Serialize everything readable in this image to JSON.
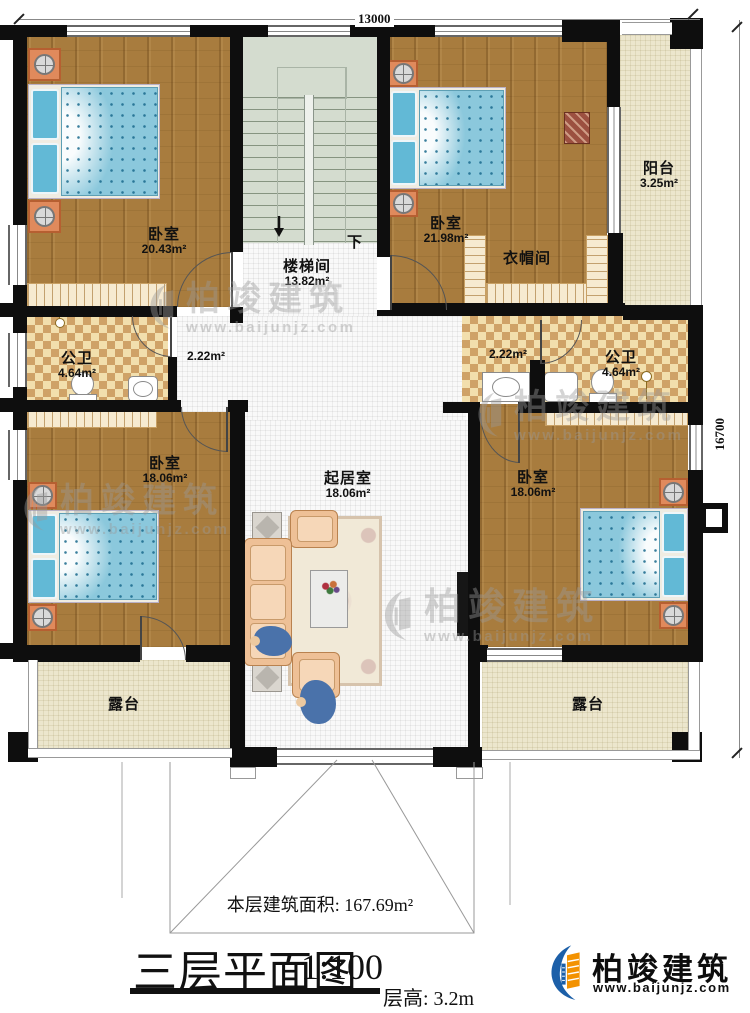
{
  "plan": {
    "dim_top": "13000",
    "dim_right": "16700",
    "stair_down": "下",
    "rooms": {
      "bedroom_tl": {
        "name": "卧室",
        "area": "20.43m²"
      },
      "stairwell": {
        "name": "楼梯间",
        "area": "13.82m²"
      },
      "bedroom_tr": {
        "name": "卧室",
        "area": "21.98m²"
      },
      "cloakroom": {
        "name": "衣帽间"
      },
      "balcony": {
        "name": "阳台",
        "area": "3.25m²"
      },
      "bath_left": {
        "name": "公卫",
        "area": "4.64m²"
      },
      "bath_right": {
        "name": "公卫",
        "area": "4.64m²"
      },
      "hall_left": {
        "area": "2.22m²"
      },
      "hall_right": {
        "area": "2.22m²"
      },
      "bedroom_bl": {
        "name": "卧室",
        "area": "18.06m²"
      },
      "living": {
        "name": "起居室",
        "area": "18.06m²"
      },
      "bedroom_br": {
        "name": "卧室",
        "area": "18.06m²"
      },
      "terrace_left": {
        "name": "露台"
      },
      "terrace_right": {
        "name": "露台"
      }
    }
  },
  "footer": {
    "floor_area": "本层建筑面积: 167.69m²",
    "title": "三层平面图",
    "scale": "1:100",
    "floor_height": "层高: 3.2m"
  },
  "brand": {
    "name": "柏竣建筑",
    "site": "www.baijunjz.com"
  },
  "colors": {
    "wall": "#0e0e0e",
    "wood_floor": "#a87c3e",
    "tile_dark": "#cfa267",
    "tile_light": "#f2dfad",
    "stair": "#d4dccf",
    "terrace": "#ece6cd",
    "bed": "#8bc8dc",
    "logo_blue": "#1c5fa8",
    "logo_orange": "#f39200"
  }
}
